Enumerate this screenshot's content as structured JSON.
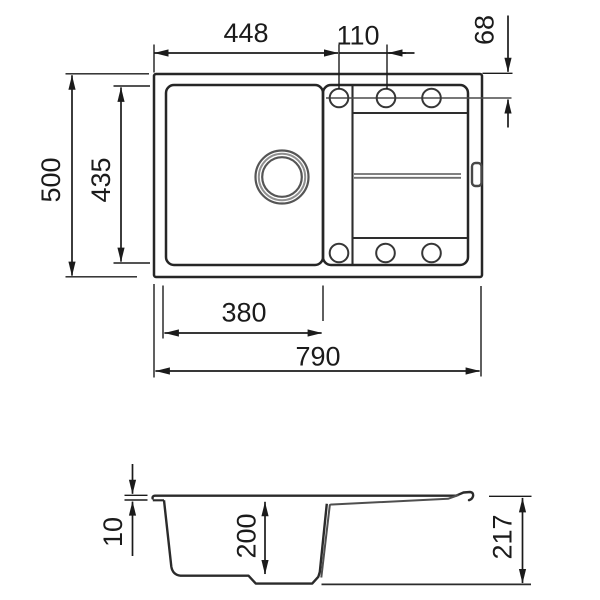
{
  "drawing": {
    "kind": "kitchen-sink-dimension-drawing",
    "colors": {
      "line": "#262626",
      "dim_line": "#1b1b1b",
      "detail_gray": "#6e6e6e",
      "background": "#ffffff"
    },
    "top_view": {
      "dim_left_edge_to_first_hole": "448",
      "dim_hole_spacing": "110",
      "dim_top_edge_to_hole_axis": "68",
      "dim_overall_depth": "500",
      "dim_bowl_depth": "435",
      "dim_bowl_width": "380",
      "dim_overall_width": "790"
    },
    "section_view": {
      "dim_rim_thickness": "10",
      "dim_bowl_inner_depth": "200",
      "dim_overall_height": "217"
    }
  }
}
